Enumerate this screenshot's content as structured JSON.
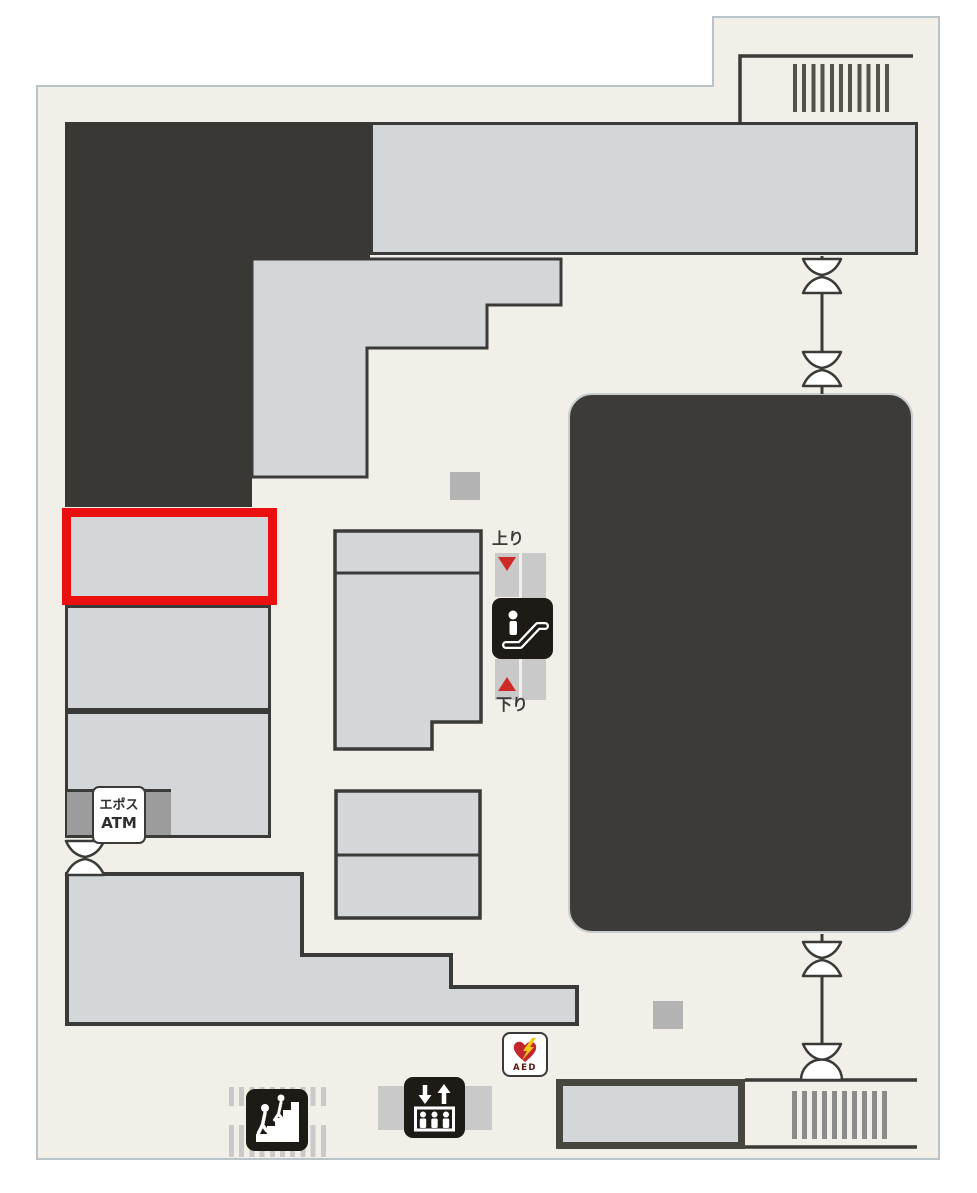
{
  "floor_map": {
    "labels": {
      "escalator_up": "上り",
      "escalator_down": "下り",
      "atm_line1": "エポス",
      "atm_line2": "ATM",
      "aed": "AED"
    },
    "colors": {
      "page_background": "#FFFFFF",
      "map_background": "#F2EFE8",
      "map_outline": "#B9C3C8",
      "dark_block": "#393834",
      "shop_block_fill": "#D3D7D9",
      "block_border": "#3A3A39",
      "highlight_red": "#EA1010",
      "arrow_red": "#CF2B26",
      "escalator_band_gray": "#C9C9C9",
      "atm_strip_gray": "#9C9C9C",
      "small_square_gray": "#B3B3B3",
      "hatch_dark": "#55524D",
      "hatch_mid": "#8B8B8B",
      "hatch_light": "#C9C9C9",
      "icon_black": "#1E1B16",
      "aed_heart_red": "#C1272D",
      "aed_bolt_yellow": "#F5C518",
      "aed_text_color": "#5C150D"
    },
    "icons": {
      "escalator": "escalator-pictogram",
      "elevator": "elevator-pictogram",
      "stairs": "stairs-pictogram",
      "aed": "aed-heart-bolt-pictogram",
      "door": "double-door-map-symbol",
      "dome_door": "half-circle-door-symbol"
    }
  }
}
